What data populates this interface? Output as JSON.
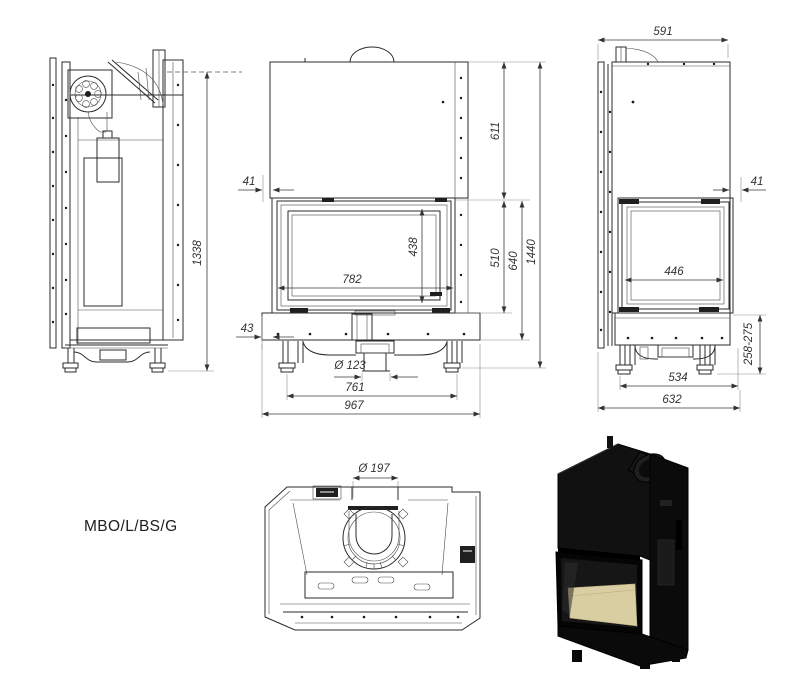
{
  "sheet": {
    "model": "MBO/L/BS/G"
  },
  "dimensions": {
    "left_overall_height": "1338",
    "front_top_inset": "41",
    "front_hood_height": "611",
    "front_glass_width": "782",
    "front_glass_height": "438",
    "front_firebox_height": "510",
    "front_base_height": "640",
    "front_overall_height": "1440",
    "front_bottom_inset": "43",
    "front_outlet_diameter": "Ø 123",
    "front_feet_span": "761",
    "front_overall_width": "967",
    "right_overall_depth_top": "591",
    "right_front_inset": "41",
    "right_glass_width": "446",
    "right_base_height_range": "258-275",
    "right_feet_span": "534",
    "right_overall_depth": "632",
    "top_flue_diameter": "Ø 197"
  },
  "colors": {
    "line": "#2b2b2b",
    "dimension_text": "#333333",
    "render_body": "#0d0d0d",
    "render_firebox_floor": "#d9cda2"
  }
}
